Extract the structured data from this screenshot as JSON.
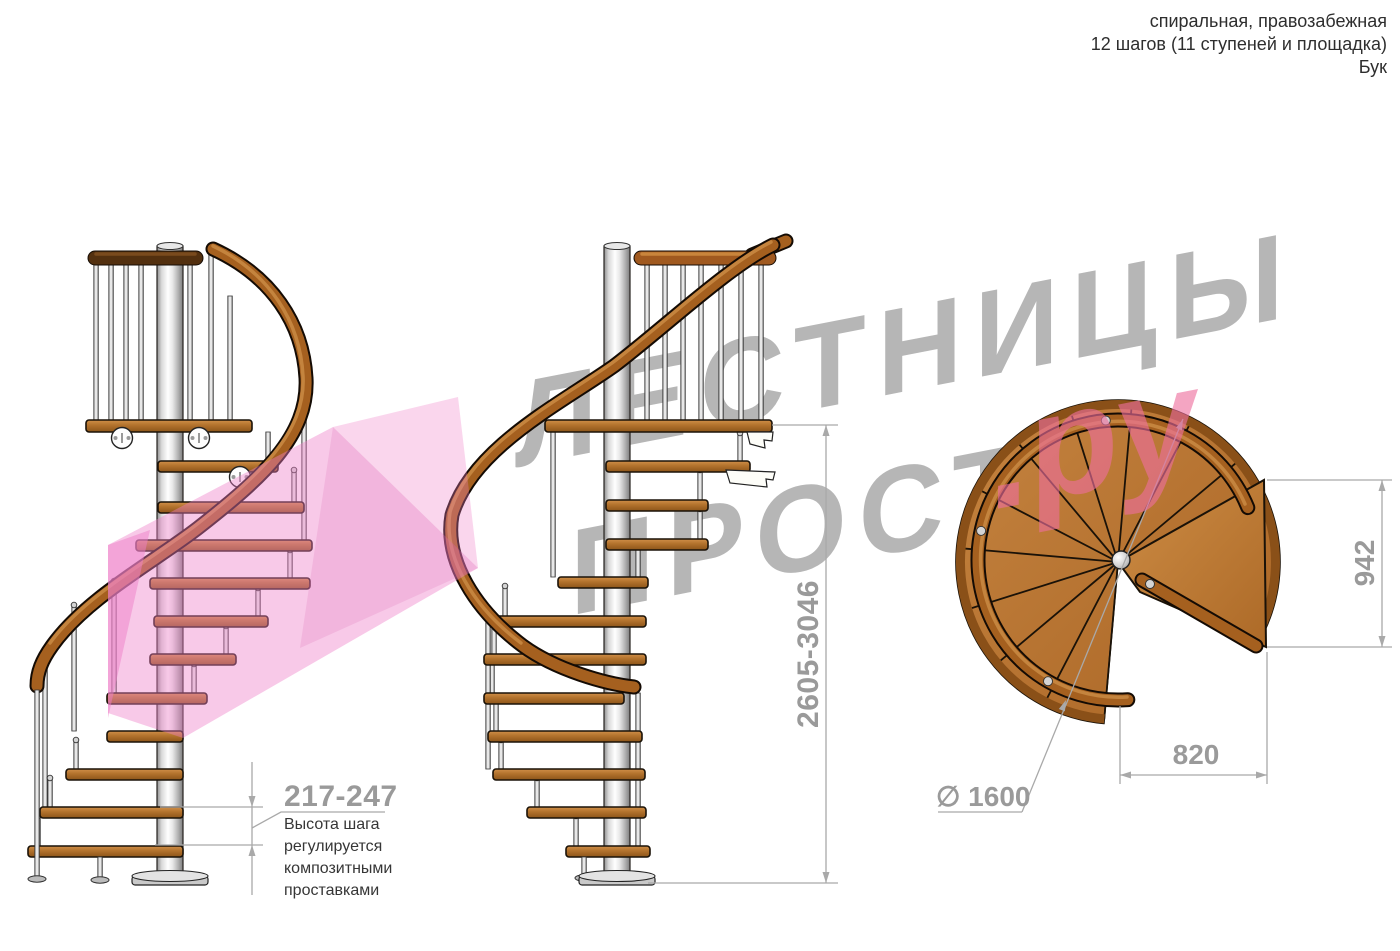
{
  "header": {
    "line1": "спиральная, правозабежная",
    "line2": "12 шагов (11 ступеней и площадка)",
    "line3": "Бук"
  },
  "watermark": {
    "brand_top": "ЛЕСТНИЦЫ",
    "brand_bottom": "ПРОСТО",
    "brand_suffix": ".ру"
  },
  "dimensions": {
    "step_height": "217-247",
    "total_height": "2605-3046",
    "plan_depth": "942",
    "plan_width": "820",
    "diameter": "∅ 1600"
  },
  "note": {
    "line1": "Высота шага",
    "line2": "регулируется",
    "line3": "композитными",
    "line4": "проставками"
  },
  "colors": {
    "wood": "#b5742e",
    "wood_dark": "#8a5018",
    "dark_rail": "#4f2d10",
    "metal": "#d9d9d9",
    "dimension_gray": "#9a9a9a",
    "watermark_gray": "#b6b6b6",
    "brand_pink": "#ee6f9e",
    "arrow_pink": "#ee7fc8"
  }
}
